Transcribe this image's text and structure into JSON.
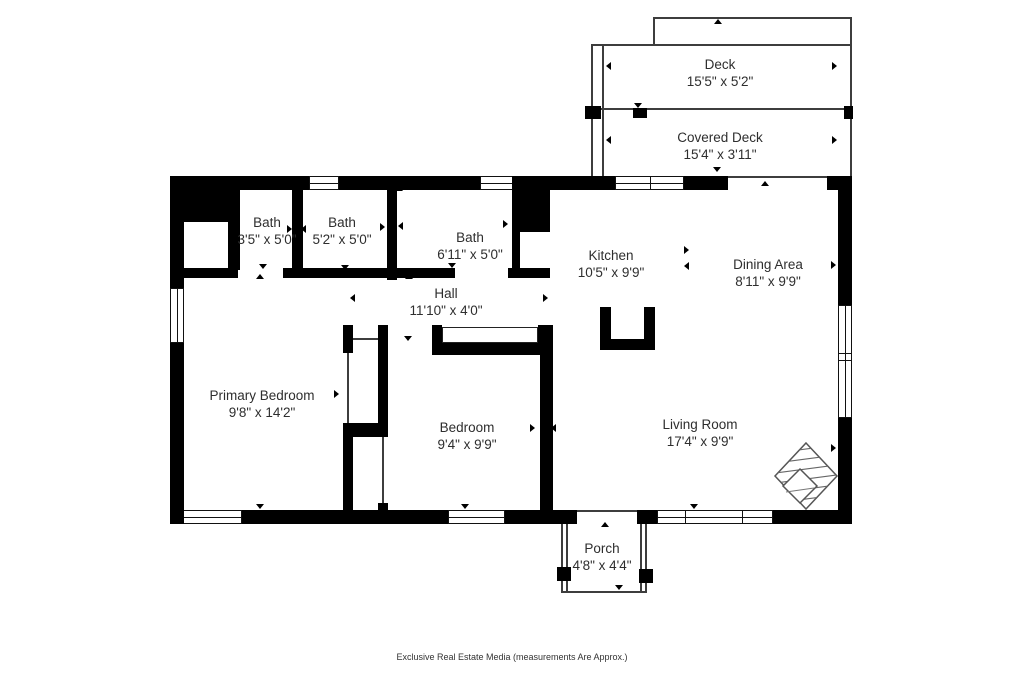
{
  "title": "Floor Plan",
  "footer": "Exclusive Real Estate Media (measurements Are Approx.)",
  "colors": {
    "wall": "#000000",
    "thin_line": "#3d3d3d",
    "text": "#2e2e2e",
    "background": "#ffffff"
  },
  "icons": {
    "compass_rose": "hatched-diamond-logo",
    "tick_marker": "small-solid-triangle"
  },
  "rooms": [
    {
      "id": "deck",
      "name": "Deck",
      "dims": "15'5\" x 5'2\""
    },
    {
      "id": "covered-deck",
      "name": "Covered Deck",
      "dims": "15'4\" x 3'11\""
    },
    {
      "id": "bath-1",
      "name": "Bath",
      "dims": "3'5\" x 5'0\""
    },
    {
      "id": "bath-2",
      "name": "Bath",
      "dims": "5'2\" x 5'0\""
    },
    {
      "id": "bath-3",
      "name": "Bath",
      "dims": "6'11\" x 5'0\""
    },
    {
      "id": "kitchen",
      "name": "Kitchen",
      "dims": "10'5\" x 9'9\""
    },
    {
      "id": "dining-area",
      "name": "Dining Area",
      "dims": "8'11\" x 9'9\""
    },
    {
      "id": "hall",
      "name": "Hall",
      "dims": "11'10\" x 4'0\""
    },
    {
      "id": "primary-bedroom",
      "name": "Primary Bedroom",
      "dims": "9'8\" x 14'2\""
    },
    {
      "id": "bedroom",
      "name": "Bedroom",
      "dims": "9'4\" x 9'9\""
    },
    {
      "id": "living-room",
      "name": "Living Room",
      "dims": "17'4\" x 9'9\""
    },
    {
      "id": "porch",
      "name": "Porch",
      "dims": "4'8\" x 4'4\""
    }
  ]
}
